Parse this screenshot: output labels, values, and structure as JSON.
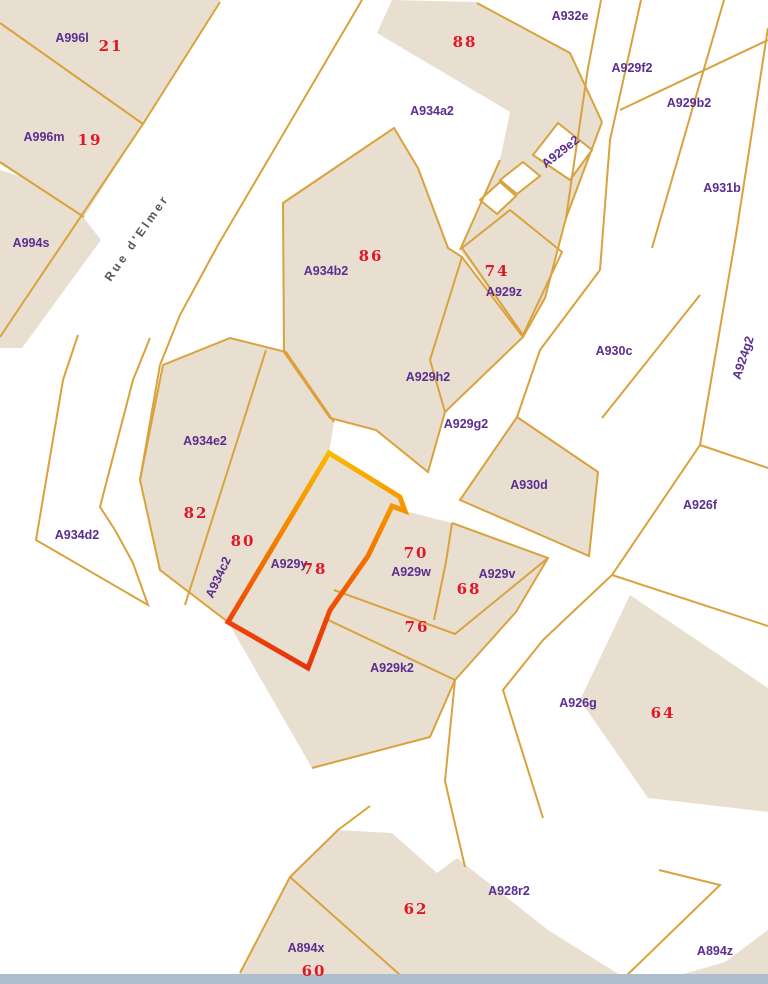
{
  "map": {
    "width": 768,
    "height": 984,
    "colors": {
      "land": "#e9dfd0",
      "boundary": "#d9a23c",
      "parcel_label": "#5b2d90",
      "house_number": "#e01826",
      "street_text": "#555555",
      "white": "#ffffff",
      "bottom_bar": "#aebdcb"
    },
    "street": {
      "t": "Rue d'Elmer",
      "x": 140,
      "y": 240,
      "r": -55
    },
    "fills": [
      {
        "n": "block-a996",
        "p": "0,0 220,0 143,124 84,217 0,164"
      },
      {
        "n": "band-a994s",
        "p": "0,170 62,190 101,240 22,348 0,348"
      },
      {
        "n": "block-top-building",
        "p": "392,0 477,2 570,53 602,122 566,218 545,298 523,337 460,250 500,160 510,112 377,33"
      },
      {
        "n": "building-a932e",
        "p": "530,58 598,120 564,138 505,72"
      },
      {
        "n": "block-a934b2",
        "p": "283,203 394,128 418,168 448,248 462,257 523,337 445,412 428,472 376,430 330,418 284,352"
      },
      {
        "n": "parcel-a930d",
        "p": "517,417 598,472 589,556 460,500"
      },
      {
        "n": "block-a934e2",
        "p": "140,480 163,365 230,338 286,352 334,422 329,453 228,622 160,570"
      },
      {
        "n": "block-a929y",
        "p": "329,453 400,497 405,511 452,523 548,558 516,612 455,680 430,737 312,768 228,622"
      },
      {
        "n": "building-a926g",
        "p": "630,595 768,688 768,812 648,798 580,700"
      },
      {
        "n": "block-bottom",
        "p": "290,877 338,830 392,833 437,873 457,858 548,930 620,975 240,975"
      },
      {
        "n": "wedge-bottom-right",
        "p": "725,962 768,930 768,975 680,975"
      }
    ],
    "white_fills": [
      {
        "n": "parcel-a929e2",
        "p": "558,123 592,150 570,180 533,155"
      },
      {
        "n": "parcel-a929e2-s1",
        "p": "500,180 523,162 540,176 517,194"
      },
      {
        "n": "parcel-a929e2-s2",
        "p": "480,200 500,182 516,196 497,214"
      }
    ],
    "outlines": [
      {
        "n": "street-edge-west",
        "p": "220,2 143,124 18,310 0,337"
      },
      {
        "n": "divider-a996l-a996m",
        "p": "0,23 143,124"
      },
      {
        "n": "divider-a996m-a994s",
        "p": "0,162 84,217"
      },
      {
        "n": "street-edge-east",
        "p": "362,0 218,245 180,315 160,365 140,480 160,570 228,622"
      },
      {
        "n": "boundary-a932e",
        "p": "477,3 570,53 602,122"
      },
      {
        "n": "strip-a929f2-west",
        "p": "601,0 588,68 566,218"
      },
      {
        "n": "strip-a929f2-east",
        "p": "641,0 610,140 600,270"
      },
      {
        "n": "strip-a930c-west",
        "p": "600,270 540,350 517,417"
      },
      {
        "n": "strip-a929b2-east",
        "p": "724,0 652,248"
      },
      {
        "n": "strip-a930c-east",
        "p": "700,295 602,418"
      },
      {
        "n": "cross-line-a931b",
        "p": "768,40 620,110"
      },
      {
        "n": "street-right-east",
        "p": "768,28 736,235 700,445 612,575 543,640 503,690 543,818"
      },
      {
        "n": "divider-a926f-a924g2",
        "p": "700,445 768,468"
      },
      {
        "n": "divider-a926f-a926g",
        "p": "612,575 768,626"
      },
      {
        "n": "street-right-west",
        "p": "516,612 455,680 445,781 465,867"
      },
      {
        "n": "edge-a929k2-south",
        "p": "455,680 430,737 312,768"
      },
      {
        "n": "parcel-a929z",
        "p": "462,248 510,210 562,252 523,335",
        "c": true
      },
      {
        "n": "divider-86-a929h2",
        "p": "462,257 430,360 445,412"
      },
      {
        "n": "outline-a934b2-block",
        "p": "283,203 394,128 418,168 448,248 462,257 523,337 445,412 428,472 376,430 330,418 284,352",
        "c": true
      },
      {
        "n": "outline-a934e2-north",
        "p": "140,480 163,365 230,338 286,352 334,422"
      },
      {
        "n": "divider-82-80",
        "p": "266,350 185,605"
      },
      {
        "n": "outline-a930d",
        "p": "517,417 598,472 589,556 460,500",
        "c": true
      },
      {
        "n": "edge-block3-east",
        "p": "602,122 566,218 545,298 523,337"
      },
      {
        "n": "edge-gap-a929z",
        "p": "460,250 500,160"
      },
      {
        "n": "divider-a929w-76",
        "p": "334,590 455,634 548,558"
      },
      {
        "n": "divider-76-a929k2",
        "p": "324,618 455,680"
      },
      {
        "n": "divider-a929w-a929v",
        "p": "452,523 446,562 434,620"
      },
      {
        "n": "edge-a929block-east",
        "p": "452,523 548,558 516,612"
      },
      {
        "n": "outline-a934d2",
        "p": "78,335 63,380 36,540 148,605 133,563 115,530 100,507 133,380 150,338"
      },
      {
        "n": "divider-a894x-62",
        "p": "290,877 400,975"
      },
      {
        "n": "edge-bottom-west",
        "p": "370,806 338,830 290,877 240,973"
      },
      {
        "n": "boundary-a894z",
        "p": "659,870 720,885 622,980"
      }
    ],
    "highlight": {
      "n": "highlighted-parcel-a929y",
      "p": "329,453 400,497 405,511 392,506 368,556 330,610 308,668 228,622",
      "width": 5,
      "y1": 453,
      "y2": 668,
      "stops": [
        [
          "0",
          "#f9bb00"
        ],
        [
          "0.25",
          "#f59600"
        ],
        [
          "0.55",
          "#f16a00"
        ],
        [
          "0.8",
          "#ec4207"
        ],
        [
          "1",
          "#e8340c"
        ]
      ]
    },
    "labels": [
      {
        "t": "A996l",
        "x": 72,
        "y": 38
      },
      {
        "t": "A996m",
        "x": 44,
        "y": 137
      },
      {
        "t": "A994s",
        "x": 31,
        "y": 243
      },
      {
        "t": "A934a2",
        "x": 432,
        "y": 111
      },
      {
        "t": "A932e",
        "x": 570,
        "y": 16
      },
      {
        "t": "A929f2",
        "x": 632,
        "y": 68
      },
      {
        "t": "A929b2",
        "x": 689,
        "y": 103
      },
      {
        "t": "A931b",
        "x": 722,
        "y": 188
      },
      {
        "t": "A929e2",
        "x": 563,
        "y": 151,
        "r": -38
      },
      {
        "t": "A934b2",
        "x": 326,
        "y": 271
      },
      {
        "t": "A929z",
        "x": 504,
        "y": 292
      },
      {
        "t": "A929h2",
        "x": 428,
        "y": 377
      },
      {
        "t": "A929g2",
        "x": 466,
        "y": 424
      },
      {
        "t": "A930c",
        "x": 614,
        "y": 351
      },
      {
        "t": "A924g2",
        "x": 747,
        "y": 355,
        "r": -72
      },
      {
        "t": "A930d",
        "x": 529,
        "y": 485
      },
      {
        "t": "A926f",
        "x": 700,
        "y": 505
      },
      {
        "t": "A934e2",
        "x": 205,
        "y": 441
      },
      {
        "t": "A934d2",
        "x": 77,
        "y": 535
      },
      {
        "t": "A934c2",
        "x": 222,
        "y": 575,
        "r": -65
      },
      {
        "t": "A929y",
        "x": 289,
        "y": 564
      },
      {
        "t": "A929w",
        "x": 411,
        "y": 572
      },
      {
        "t": "A929v",
        "x": 497,
        "y": 574
      },
      {
        "t": "A929k2",
        "x": 392,
        "y": 668
      },
      {
        "t": "A926g",
        "x": 578,
        "y": 703
      },
      {
        "t": "A928r2",
        "x": 509,
        "y": 891
      },
      {
        "t": "A894x",
        "x": 306,
        "y": 948
      },
      {
        "t": "A894z",
        "x": 715,
        "y": 951
      }
    ],
    "numbers": [
      {
        "t": "21",
        "x": 111,
        "y": 46
      },
      {
        "t": "19",
        "x": 90,
        "y": 140
      },
      {
        "t": "88",
        "x": 465,
        "y": 42
      },
      {
        "t": "86",
        "x": 371,
        "y": 256
      },
      {
        "t": "74",
        "x": 497,
        "y": 271
      },
      {
        "t": "82",
        "x": 196,
        "y": 513
      },
      {
        "t": "80",
        "x": 243,
        "y": 541
      },
      {
        "t": "78",
        "x": 315,
        "y": 569
      },
      {
        "t": "70",
        "x": 416,
        "y": 553
      },
      {
        "t": "68",
        "x": 469,
        "y": 589
      },
      {
        "t": "76",
        "x": 417,
        "y": 627
      },
      {
        "t": "64",
        "x": 663,
        "y": 713
      },
      {
        "t": "62",
        "x": 416,
        "y": 909
      },
      {
        "t": "60",
        "x": 314,
        "y": 971
      }
    ],
    "bottom_bar": {
      "y": 974,
      "h": 10
    }
  }
}
